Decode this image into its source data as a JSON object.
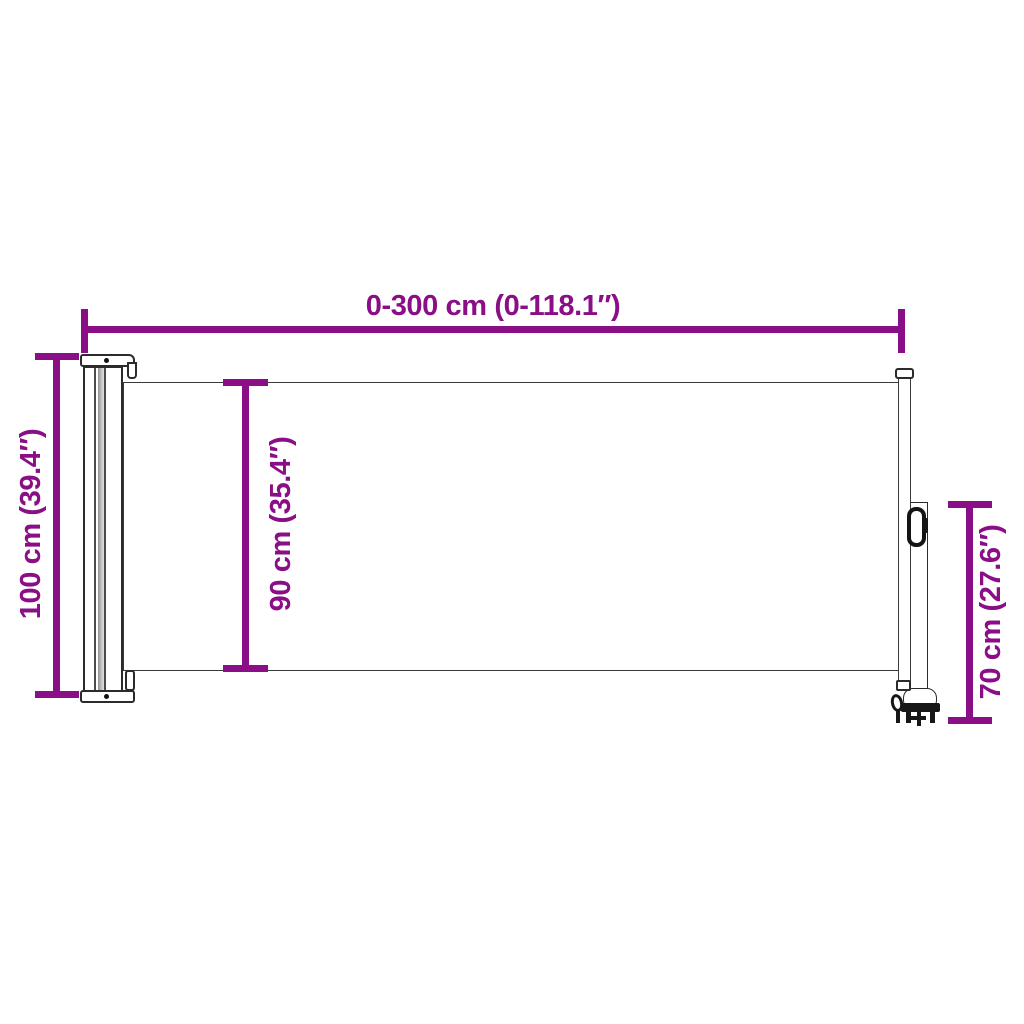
{
  "dimensions": {
    "width": {
      "label": "0-300 cm (0-118.1″)"
    },
    "total_height": {
      "label": "100 cm (39.4″)"
    },
    "fabric_height": {
      "label": "90 cm (35.4″)"
    },
    "post_height": {
      "label": "70 cm (27.6″)"
    }
  },
  "colors": {
    "dimension_accent": "#8A0E86",
    "outline": "#2B2B2B",
    "background": "#FFFFFF",
    "shading": "#BDBDBD"
  }
}
